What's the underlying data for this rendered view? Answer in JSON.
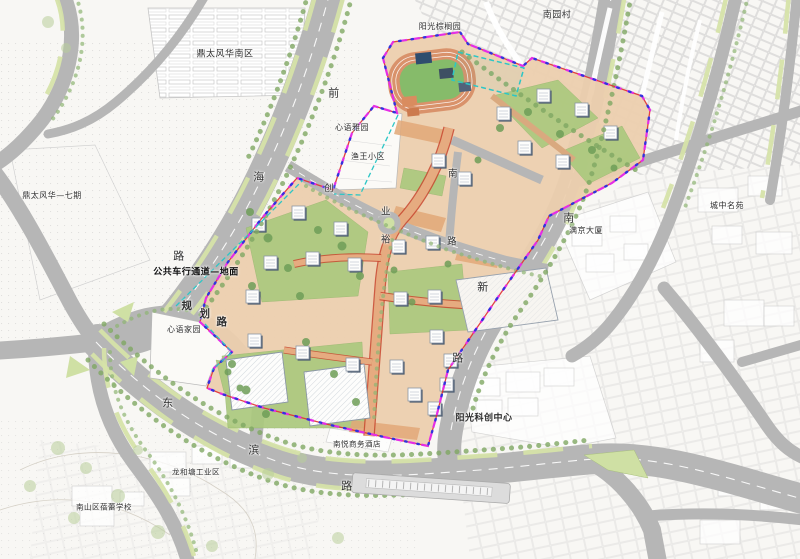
{
  "map": {
    "type": "urban-planning-site-plan",
    "roads": {
      "qianhai": "前海路",
      "dongbin": "东滨路",
      "nanxin": "南新路",
      "guihua": "规划路",
      "chuangye": "创业路"
    },
    "annotation": "公共车行通道—地面",
    "colors": {
      "paper": "#f8f7f4",
      "road_gray": "#b6b6b6",
      "verge_green": "#d6e3a9",
      "tree_green": "#7fa863",
      "lawn_green": "#abc97e",
      "site_paving": "#eccfae",
      "plaza_tan": "#e2a878",
      "internal_road": "#e6ab80",
      "internal_road_edge": "#c8472f",
      "building_white": "#fdfdfc",
      "roof_shadow": "#4a5b70",
      "roof_dark": "#3e4f63",
      "track_orange": "#d9926b",
      "field_green": "#86bb6a",
      "boundary_magenta": "#e52ee5",
      "boundary_blue": "#3232dd",
      "boundary_red": "#e03030",
      "boundary_cyan": "#2cc6c6"
    },
    "labels": [
      {
        "id": "dingtai-nan",
        "text": "鼎太风华南区",
        "x": 225,
        "y": 55,
        "size": 9
      },
      {
        "id": "dingtai-qiqi",
        "text": "鼎太风华—七期",
        "x": 52,
        "y": 196,
        "size": 8
      },
      {
        "id": "yangguang-zonglvyuan",
        "text": "阳光棕榈园",
        "x": 440,
        "y": 27,
        "size": 8
      },
      {
        "id": "nanyuancun",
        "text": "南园村",
        "x": 557,
        "y": 16,
        "size": 9
      },
      {
        "id": "xinyu-yayuan",
        "text": "心语雅园",
        "x": 352,
        "y": 128,
        "size": 8
      },
      {
        "id": "yuwang-xiaoqu",
        "text": "渔王小区",
        "x": 368,
        "y": 157,
        "size": 8
      },
      {
        "id": "xinyu-jiayuan",
        "text": "心语家园",
        "x": 184,
        "y": 330,
        "size": 8
      },
      {
        "id": "chengzhong-mingyuan",
        "text": "城中名苑",
        "x": 727,
        "y": 206,
        "size": 8
      },
      {
        "id": "manjing-dasha",
        "text": "满京大厦",
        "x": 586,
        "y": 231,
        "size": 8
      },
      {
        "id": "nanyue-hotel",
        "text": "南悦商务酒店",
        "x": 357,
        "y": 444,
        "size": 7.5
      },
      {
        "id": "yangguang-kechuang",
        "text": "阳光科创中心",
        "x": 484,
        "y": 419,
        "size": 9,
        "weight": 700
      },
      {
        "id": "gongyequ",
        "text": "龙和塘工业区",
        "x": 196,
        "y": 472,
        "size": 7.5
      },
      {
        "id": "xuexiao",
        "text": "南山区蓓蕾学校",
        "x": 104,
        "y": 507,
        "size": 7.5
      },
      {
        "id": "tunnel-note",
        "text": "公共车行通道—地面",
        "x": 196,
        "y": 273,
        "size": 9,
        "weight": 700,
        "color": "#111111"
      },
      {
        "id": "guihua-1",
        "text": "规",
        "x": 187,
        "y": 306,
        "size": 10.5,
        "weight": 700
      },
      {
        "id": "guihua-2",
        "text": "划",
        "x": 205,
        "y": 314,
        "size": 10.5,
        "weight": 700
      },
      {
        "id": "guihua-3",
        "text": "路",
        "x": 222,
        "y": 322,
        "size": 10.5,
        "weight": 700
      },
      {
        "id": "qianhai-1",
        "text": "前",
        "x": 334,
        "y": 93,
        "size": 11
      },
      {
        "id": "qianhai-2",
        "text": "海",
        "x": 259,
        "y": 177,
        "size": 11
      },
      {
        "id": "qianhai-3",
        "text": "路",
        "x": 179,
        "y": 256,
        "size": 11
      },
      {
        "id": "dongbin-1",
        "text": "东",
        "x": 168,
        "y": 403,
        "size": 11
      },
      {
        "id": "dongbin-2",
        "text": "滨",
        "x": 254,
        "y": 450,
        "size": 11
      },
      {
        "id": "dongbin-3",
        "text": "路",
        "x": 347,
        "y": 486,
        "size": 11
      },
      {
        "id": "nanxin-1",
        "text": "南",
        "x": 569,
        "y": 218,
        "size": 11
      },
      {
        "id": "nanxin-2",
        "text": "新",
        "x": 483,
        "y": 287,
        "size": 11
      },
      {
        "id": "nanxin-3",
        "text": "路",
        "x": 458,
        "y": 358,
        "size": 11
      },
      {
        "id": "chuangye-1",
        "text": "创",
        "x": 329,
        "y": 189,
        "size": 9.5
      },
      {
        "id": "chuangye-2",
        "text": "业",
        "x": 386,
        "y": 212,
        "size": 9.5
      },
      {
        "id": "chuangye-3",
        "text": "路",
        "x": 452,
        "y": 242,
        "size": 9.5
      },
      {
        "id": "inner-nan",
        "text": "南",
        "x": 453,
        "y": 174,
        "size": 9.5
      },
      {
        "id": "inner-yu",
        "text": "裕",
        "x": 386,
        "y": 240,
        "size": 9.5
      }
    ]
  }
}
